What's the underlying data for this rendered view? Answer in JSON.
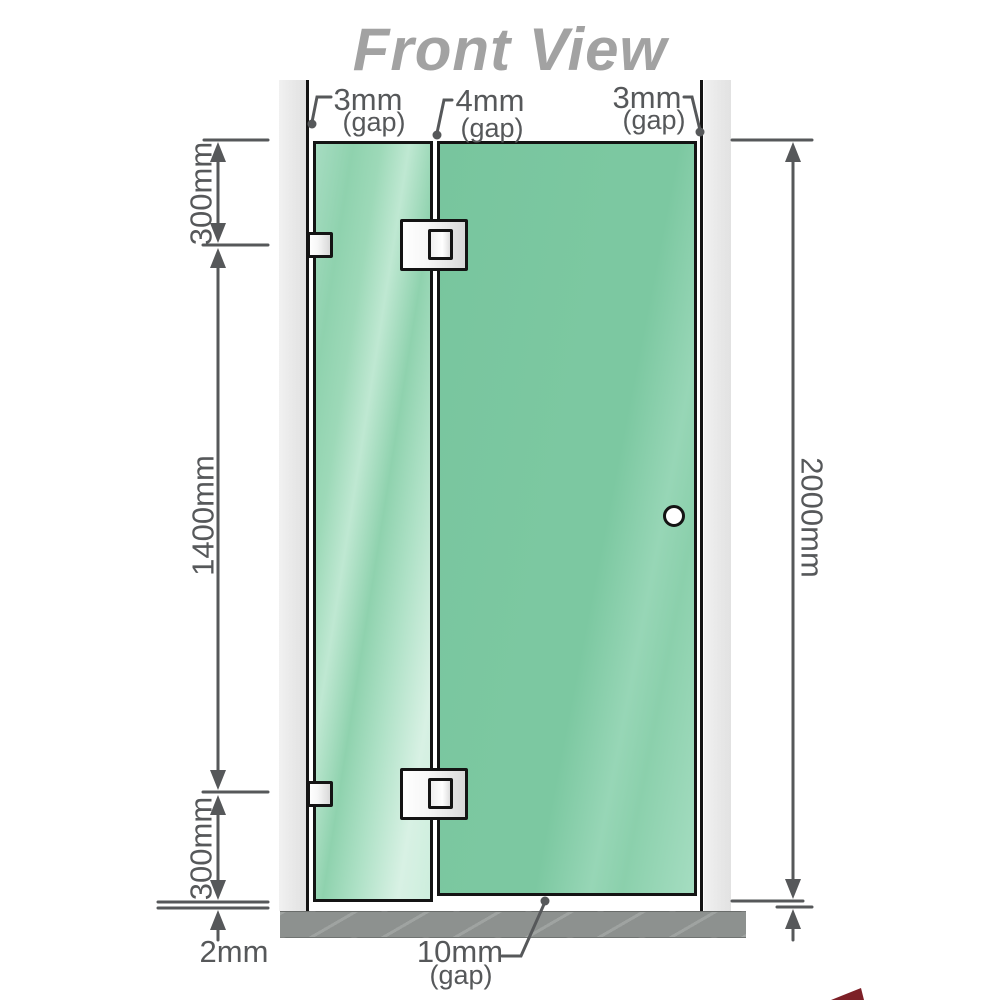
{
  "title": "Front View",
  "top_gaps": {
    "left": {
      "value": "3mm",
      "suffix": "(gap)"
    },
    "middle": {
      "value": "4mm",
      "suffix": "(gap)"
    },
    "right": {
      "value": "3mm",
      "suffix": "(gap)"
    }
  },
  "bottom_gap": {
    "value": "10mm",
    "suffix": "(gap)"
  },
  "side_dimensions": {
    "top_segment": "300mm",
    "middle_segment": "1400mm",
    "bottom_segment": "300mm",
    "total_height": "2000mm",
    "floor_clearance": "2mm"
  },
  "colors": {
    "glass_green": "#7cc8a1",
    "glass_green_light": "#cdeedd",
    "wall_gray": "#e8e8e8",
    "floor_gray": "#8d918f",
    "dimension_gray": "#56585a",
    "title_gray": "#a2a2a2",
    "hardware_white": "#ffffff",
    "outline_black": "#141414",
    "watermark_red": "#7d2027"
  }
}
